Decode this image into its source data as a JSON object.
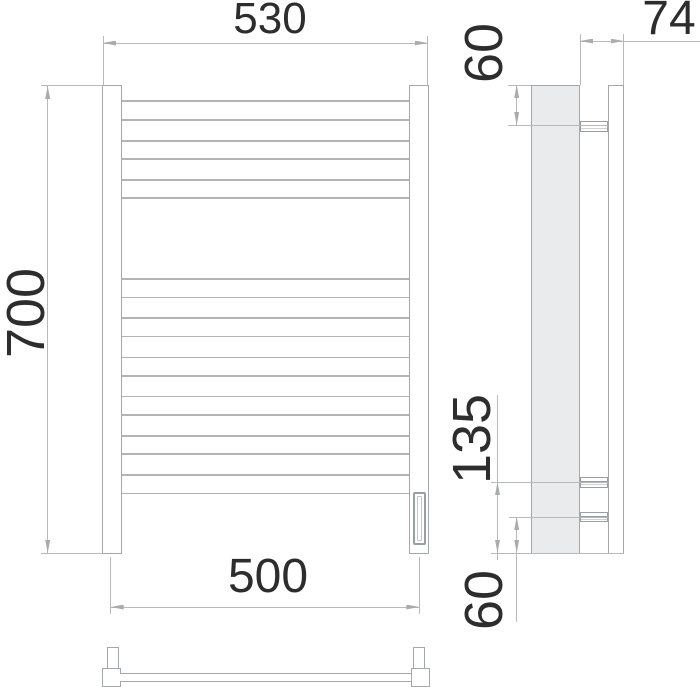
{
  "drawing": {
    "type_label": "towel-rail-dimension-drawing",
    "dimensions": {
      "front_width": "530",
      "front_height": "700",
      "axis_spacing": "500",
      "side_depth": "74",
      "side_top_offset": "60",
      "side_connection_height": "135",
      "side_bottom_offset": "60"
    },
    "colors": {
      "background": "#ffffff",
      "outline": "#a5a8aa",
      "thin_line": "#b2b4b6",
      "dimension_line": "#b7b9bb",
      "arrow": "#a9acae",
      "side_fill": "#eaebec",
      "text": "#2d2d2d"
    },
    "front_view": {
      "rung_span_x": [
        121.5,
        408.5
      ],
      "rung_lines_y": [
        100,
        119.3,
        140,
        158.3,
        179.3,
        197.3,
        278.3,
        296.7,
        317.3,
        335.7,
        356.7,
        375,
        395.7,
        414,
        435,
        453.3,
        474,
        492.7
      ]
    },
    "side_view": {
      "stub_tops_y": [
        120.5,
        477,
        511.8
      ],
      "stub_heights": [
        11.2,
        10.5,
        10.5
      ]
    }
  }
}
